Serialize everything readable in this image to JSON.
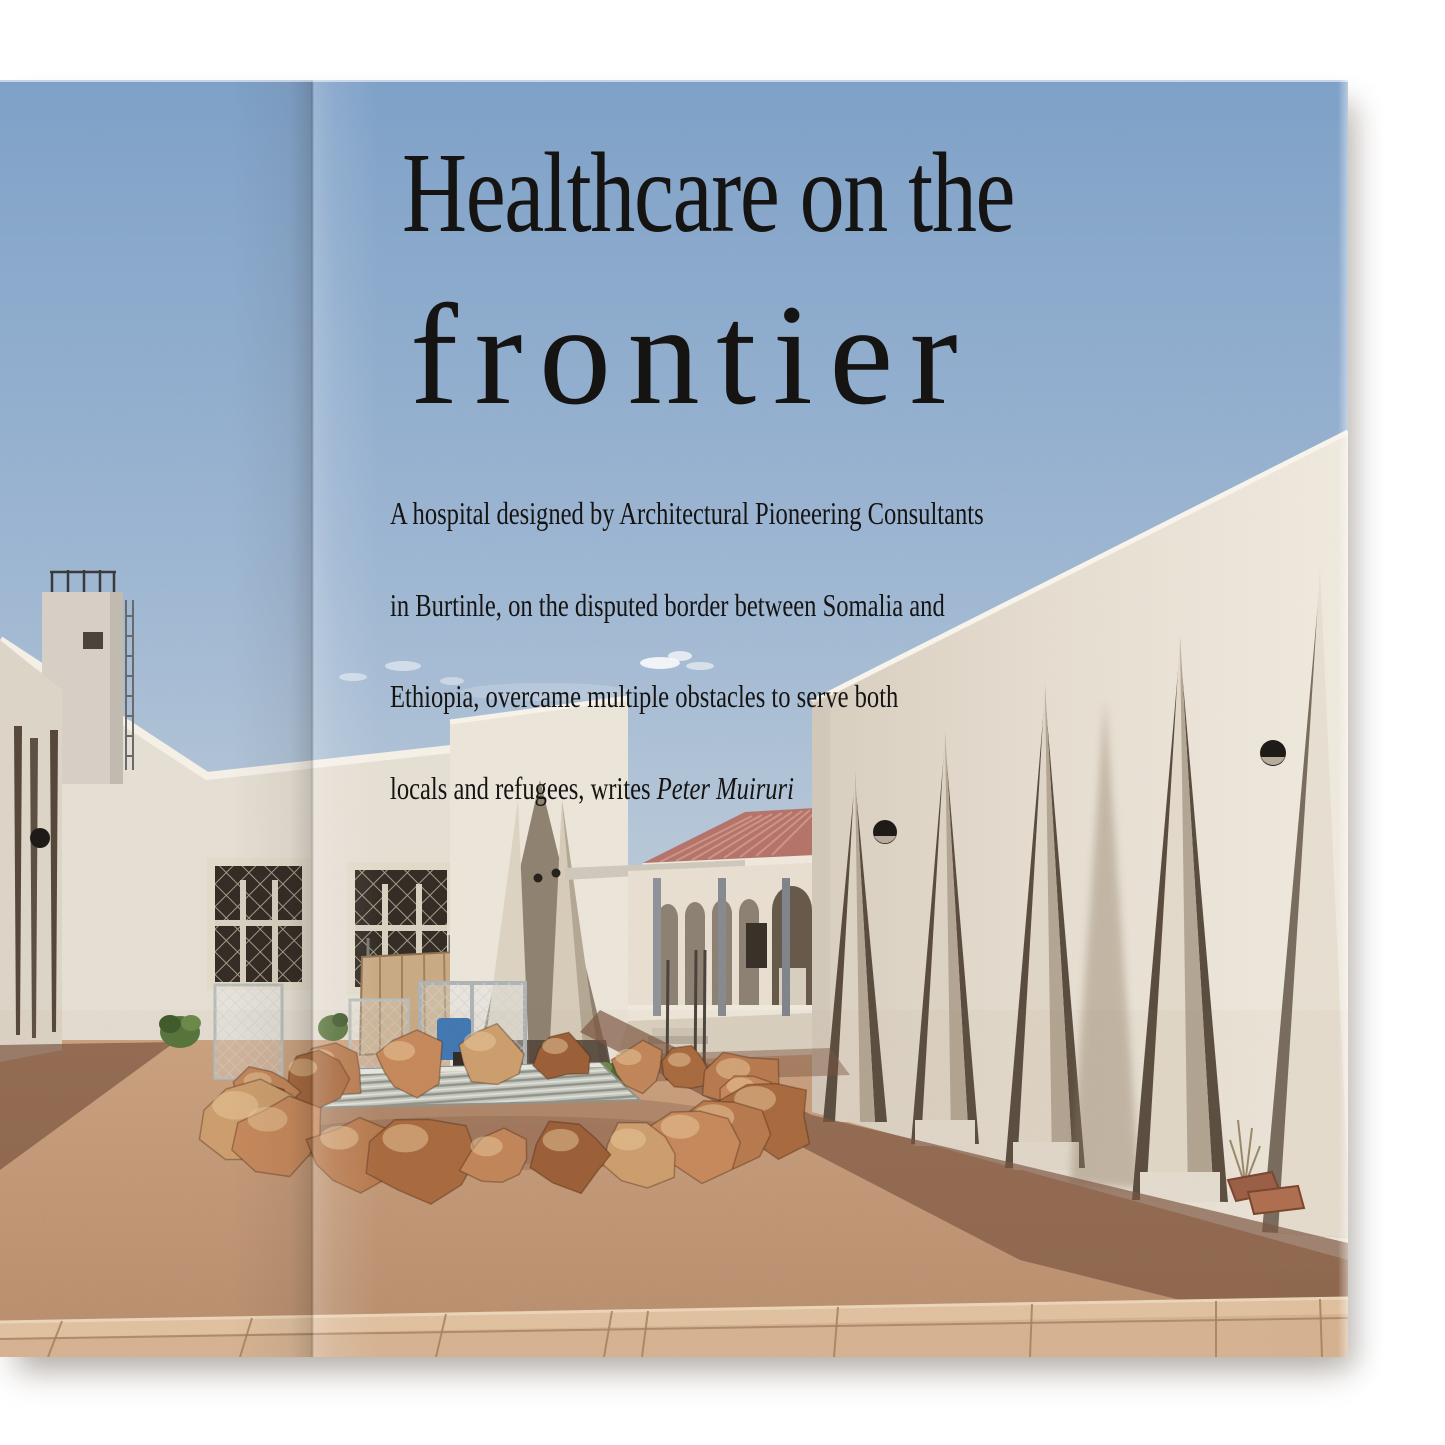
{
  "article": {
    "headline_line1": "Healthcare on the",
    "headline_line2": "frontier",
    "standfirst_line1": "A hospital designed by Architectural Pioneering Consultants",
    "standfirst_line2": "in Burtinle, on the disputed border between Somalia and",
    "standfirst_line3": "Ethiopia, overcame multiple obstacles to serve both",
    "standfirst_line4_prefix": "locals and refugees, writes ",
    "standfirst_author": "Peter Muiruri"
  },
  "page": {
    "background": "#ffffff",
    "text_color": "#151413"
  },
  "photo": {
    "palette": {
      "sky_top": "#7fa2c9",
      "sky_mid": "#9cb6d3",
      "sky_horizon": "#ccd6de",
      "wall_sunlit": "#eae3d8",
      "wall_shaded": "#d8d0c3",
      "wall_recess": "#b9ae9c",
      "roof_red": "#b5746a",
      "roof_stripe": "#d29a8d",
      "gravel": "#c79d7c",
      "gravel_far": "#d4ac89",
      "shadow_brown": "#7b5440",
      "rock_tones": [
        "#a96a3e",
        "#b97a4e",
        "#c88a5c",
        "#cfa06f",
        "#9c5f38",
        "#c3875a"
      ],
      "rock_highlight": "#eecda0",
      "pavement": "#d8b695",
      "pavement_light": "#e3c4a3",
      "pavement_joint": "#a8825f",
      "steel_gray": "#8f949a",
      "lamp_black": "#1d1a17",
      "drum_blue": "#3f78b5",
      "grate_gray": "#c7cac2",
      "shrub_green": "#56743c"
    }
  }
}
